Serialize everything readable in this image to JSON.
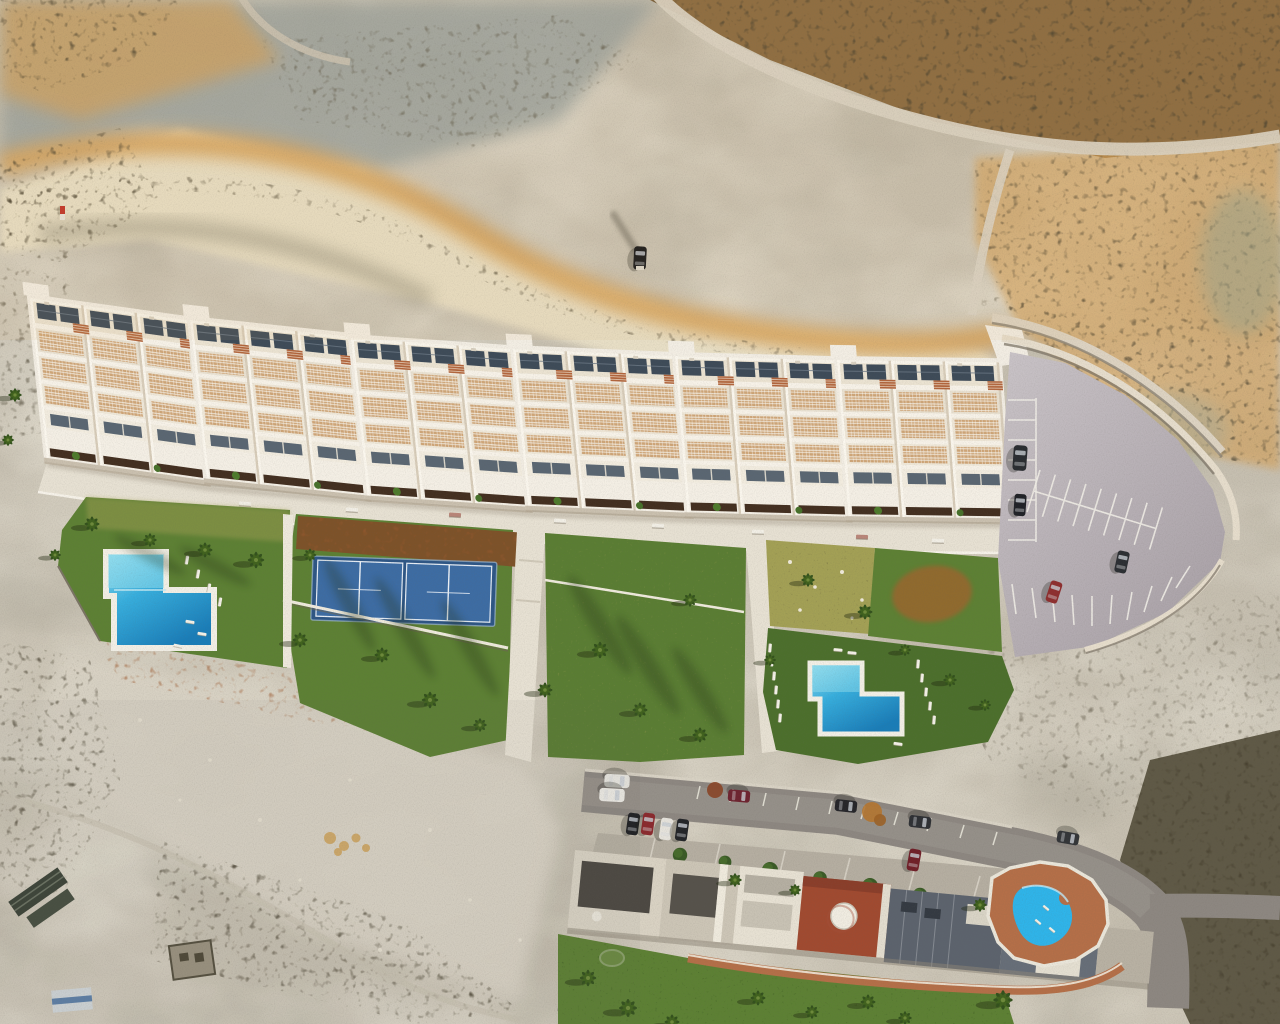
{
  "scene": {
    "kind": "aerial-drone-photograph",
    "subject": "architectural render of a new hillside residential development composited onto arid badlands terrain, existing street of houses below",
    "view": "top-down",
    "lighting": "low warm sun from upper right, long shadows to lower left"
  },
  "colors": {
    "sand": "#c6bfb0",
    "sand_light": "#d9d3c5",
    "sand_pale": "#e8dfc6",
    "gold": "#d5a057",
    "gold_deep": "#b77f3a",
    "grey_blue": "#97a09f",
    "scrub_dark": "#463f2e",
    "scrub_brown": "#8a6a40",
    "rust": "#9c5a30",
    "building_white": "#f2ede3",
    "roof_cream": "#ebe3d2",
    "pergola": "#cfa678",
    "terracotta": "#b2653c",
    "solar": "#3e4b58",
    "window": "#5a6672",
    "hedge": "#432f20",
    "lawn": "#5d8034",
    "lawn_dark": "#4c6f2c",
    "lawn_dry": "#a3a055",
    "mulch": "#7d5229",
    "pool_light": "#9ae2f2",
    "pool_mid": "#37aedd",
    "pool_deep": "#1a7db8",
    "pool_bright": "#2fb4e9",
    "court": "#2e5685",
    "court_light": "#3d6ca3",
    "path": "#e7e1d3",
    "asphalt": "#b5adb3",
    "street": "#8d8781",
    "roof_dark": "#4c4842",
    "roof_red": "#a04a30",
    "roof_blue": "#5c636d",
    "deck_terra": "#b46f48"
  },
  "new_development": {
    "building_blocks": 6,
    "units_per_block": 3,
    "solar_panels_per_unit": 2,
    "promenade_benches": 8,
    "amenities": [
      "L-shaped pool west",
      "double padel court",
      "lawn gardens",
      "dry garden with rocks",
      "L-shaped pool east",
      "open-air parking"
    ],
    "pool_west": {
      "shape": "L",
      "loungers": 7
    },
    "pool_east": {
      "shape": "L",
      "loungers": 14
    },
    "padel_courts": 2,
    "parking": {
      "marked_stalls": true,
      "cars": 4,
      "car_colors": [
        "dark",
        "dark",
        "red",
        "dark"
      ]
    }
  },
  "existing_neighbourhood": {
    "street_parked_cars": 11,
    "street_car_colors": [
      "white",
      "white",
      "dark-red",
      "black",
      "dark",
      "black",
      "red",
      "white",
      "black",
      "dark-red",
      "dark"
    ],
    "courtyard_trees": 8,
    "red_roof_with_white_dome": 1,
    "community_pool": {
      "shape": "freeform",
      "deck": "terracotta",
      "loungers": 3
    }
  },
  "terrain": {
    "features": [
      "badlands cliffs",
      "golden sunlit ridges",
      "shadowed plateau",
      "dense scrub field",
      "dirt track with parked 4x4",
      "sandy basin",
      "stone ruin",
      "greenhouse sheds",
      "white utility shed",
      "rock pile",
      "red trail marker"
    ],
    "vehicles_on_track": 1,
    "palm_trees": 34
  }
}
